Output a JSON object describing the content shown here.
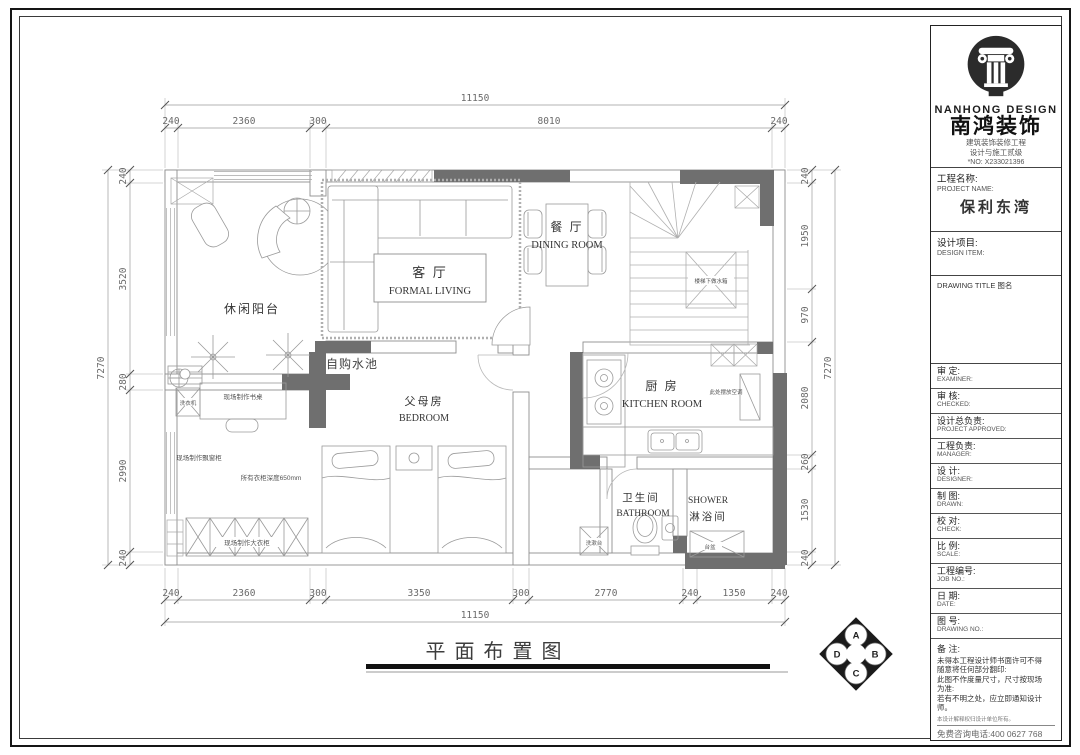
{
  "colors": {
    "wall_dark": "#6f6f6f",
    "line": "#9a9a9a",
    "dim_text": "#6a6a6a",
    "frame": "#151515"
  },
  "dims": {
    "top": {
      "total": "11150",
      "segs": [
        "240",
        "2360",
        "300",
        "8010",
        "240"
      ]
    },
    "bottom": {
      "total": "11150",
      "segs": [
        "240",
        "2360",
        "300",
        "3350",
        "300",
        "2770",
        "240",
        "1350",
        "240"
      ]
    },
    "left": {
      "total": "7270",
      "segs": [
        "240",
        "3520",
        "280",
        "2990",
        "240"
      ]
    },
    "right": {
      "total": "7270",
      "segs": [
        "240",
        "1950",
        "970",
        "2080",
        "260",
        "1530",
        "240"
      ]
    }
  },
  "rooms": {
    "balcony": {
      "cn": "休闲阳台"
    },
    "living": {
      "cn": "客 厅",
      "en": "FORMAL LIVING"
    },
    "dining": {
      "cn": "餐 厅",
      "en": "DINING ROOM"
    },
    "kitchen": {
      "cn": "厨 房",
      "en": "KITCHEN ROOM"
    },
    "bedroom": {
      "cn": "父母房",
      "en": "BEDROOM"
    },
    "bathroom": {
      "cn": "卫生间",
      "en": "BATHROOM"
    },
    "shower": {
      "cn": "淋浴间",
      "en": "SHOWER"
    }
  },
  "annotations": {
    "sink": "自购水池",
    "desk": "现场制作书桌",
    "washer": "洗衣机",
    "bay_cabinet": "现场制作飘窗柜",
    "wardrobe_depth": "所有衣柜深度650mm",
    "wardrobe": "现场制作大衣柜",
    "stair_tank": "楼梯下做水箱",
    "fridge_note": "此处摆放空调",
    "vanity": "洗漱台",
    "basin": "台盆"
  },
  "footer": {
    "title": "平面布置图"
  },
  "compass": {
    "n": "A",
    "e": "B",
    "s": "C",
    "w": "D"
  },
  "title_block": {
    "brand_en": "NANHONG DESIGN",
    "brand_cn": "南鸿装饰",
    "cert_line1": "建筑装饰装修工程",
    "cert_line2": "设计与施工贰级",
    "cert_no": "*NO: X233021396",
    "project": {
      "label_cn": "工程名称:",
      "label_en": "PROJECT NAME:",
      "value": "保利东湾"
    },
    "design_item": {
      "label_cn": "设计项目:",
      "label_en": "DESIGN ITEM:"
    },
    "drawing_title": {
      "label": "DRAWING TITLE 图名"
    },
    "rows": [
      {
        "cn": "审  定:",
        "en": "EXAMINER:"
      },
      {
        "cn": "审  核:",
        "en": "CHECKED:"
      },
      {
        "cn": "设计总负责:",
        "en": "PROJECT APPROVED:"
      },
      {
        "cn": "工程负责:",
        "en": "MANAGER:"
      },
      {
        "cn": "设  计:",
        "en": "DESIGNER:"
      },
      {
        "cn": "制  图:",
        "en": "DRAWN:"
      },
      {
        "cn": "校  对:",
        "en": "CHECK:"
      },
      {
        "cn": "比  例:",
        "en": "SCALE:"
      },
      {
        "cn": "工程编号:",
        "en": "JOB NO.:"
      },
      {
        "cn": "日  期:",
        "en": "DATE:"
      },
      {
        "cn": "图  号:",
        "en": "DRAWING NO.:"
      }
    ],
    "notes": {
      "label": "备  注:",
      "lines": [
        "未得本工程设计师书面许可不得",
        "随意将任何部分翻印:",
        "此图不作度量尺寸，尺寸按现场",
        "为准:",
        "若有不明之处，应立即通知设计",
        "师。"
      ],
      "fine": "本设计解释权归设计单位所有。",
      "hotline": "免费咨询电话:400 0627 768"
    }
  }
}
